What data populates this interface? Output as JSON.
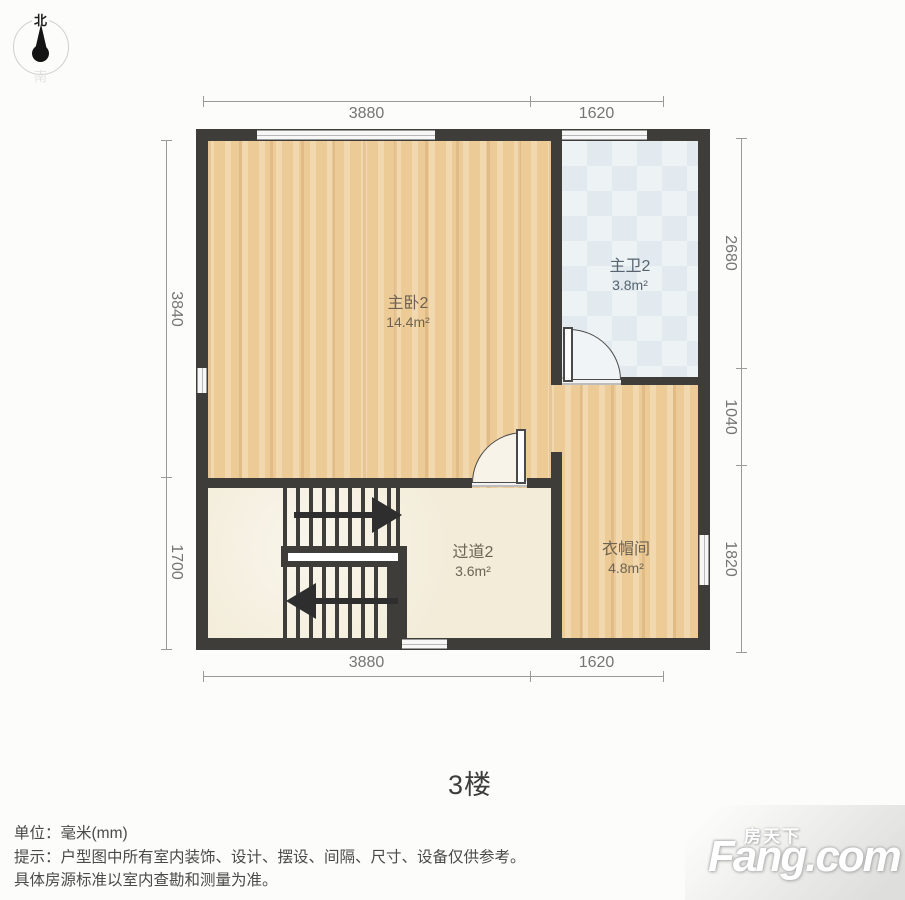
{
  "compass": {
    "north": "北",
    "south": "南"
  },
  "plan": {
    "floor_label": "3楼",
    "rooms": [
      {
        "name": "主卧2",
        "area": "14.4m²"
      },
      {
        "name": "主卫2",
        "area": "3.8m²"
      },
      {
        "name": "过道2",
        "area": "3.6m²"
      },
      {
        "name": "衣帽间",
        "area": "4.8m²"
      }
    ],
    "dimensions": {
      "top": [
        "3880",
        "1620"
      ],
      "bottom": [
        "3880",
        "1620"
      ],
      "left": [
        "3840",
        "1700"
      ],
      "right": [
        "2680",
        "1040",
        "1820"
      ]
    }
  },
  "footer": {
    "unit": "单位：毫米(mm)",
    "tip": "提示：户型图中所有室内装饰、设计、摆设、间隔、尺寸、设备仅供参考。",
    "tip2": "具体房源标准以室内查勘和测量为准。"
  },
  "watermark": {
    "cn": "房天下",
    "en": "Fang.com"
  },
  "colors": {
    "wall": "#3f3d3a",
    "wood_floor": "#eccb97",
    "cream_floor": "#f3ecd9",
    "tile_floor": "#e7edf1",
    "dimension_text": "#757575",
    "footer_text": "#4a4a4a",
    "watermark_text": "#ffffff"
  }
}
